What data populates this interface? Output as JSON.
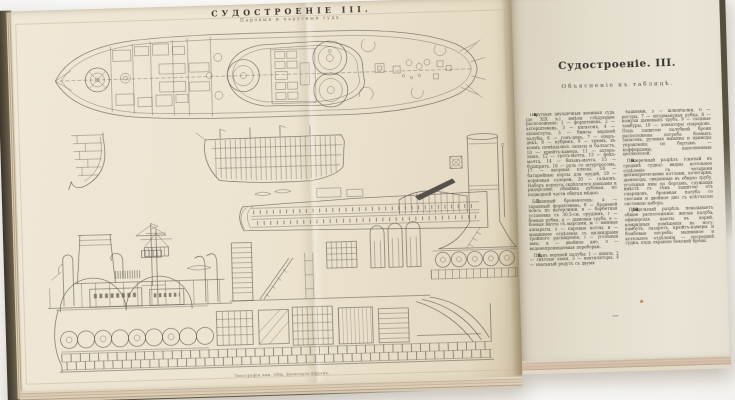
{
  "photo": {
    "background": "#fcfcfb"
  },
  "book": {
    "plate_page": {
      "title": "СУДОСТРОЕНІЕ III.",
      "subtitle": "Паровыя и парусныя суда.",
      "imprint": "Типографія Акц. Общ. Брокгаузъ-Ефронъ.",
      "figures": [
        "battleship-deck-plan-top-view",
        "bow-body-section",
        "sailing-warship-longitudinal-section",
        "military-mast-detail",
        "steamer-longitudinal-section-with-barbette-gun-and-funnel",
        "superstructure-side-view-with-funnels-and-mast",
        "hull-section-with-boilers-and-double-bottom"
      ]
    },
    "text_page": {
      "heading": "Судостроеніе. III.",
      "subheading": "Объясненіе къ таблицѣ.",
      "columns": [
        {
          "paragraphs": [
            {
              "lead": "6.",
              "text": "Парусныя двухдечныя военныя суда (до XIX в.) имѣли слѣдующее расположеніе: 1 — форштевень, 2 — ахтерштевень, 3 — кильсонъ, 4 — шпангоуты, 5 — бимсы верхней палубы, 6 — гонъ-декъ, 7 — оперъ-декъ, 8 — кубрикъ, 9 — трюмъ, въ коемъ помѣщались запасы и балластъ, 10 — крюйтъ-камера, 11 — ахтеръ-люкъ, 12 — гротъ-мачта, 13 — фокъ-мачта, 14 — бизань-мачта, 15 — бушпритъ, 16 — руль со штуртросомъ, 17 — якорные клюзы, 18 — батарейные порты для орудій, 19 — кормовыя галереи, 20 — гальюнъ. Наборъ корпуса скрѣплялся кницами и ридерсами; обшивка дубовая, по подводной части обитая мѣдью."
            },
            {
              "lead": "7.",
              "text": "Башенный броненосецъ: а — таранный форштевень, б — броневой поясъ по ватерлиніи, в — барбетная установка съ 30,5-см. орудіемъ, г — боевая рубка, д — дымовая труба, е — боевая мачта съ марсами, ж — минные аппараты, з — паровые котлы, и — машинное отдѣленіе съ цилиндрами тройного расширенія, і — угольныя ямы, к — двойное дно, л — водонепроницаемыя переборки."
            },
            {
              "lead": "8.",
              "text": "Планъ верхней палубы: 1 — шпиль, 2 — свѣтлые люки, 3 — вентиляторы, 4 — овальный редутъ съ двумя"
            }
          ]
        },
        {
          "paragraphs": [
            {
              "lead": "",
              "text": "башнями, 5 — шлюпбалки, 6 — ростры, 7 — штурманская рубка, 8 — кожухи дымовыхъ трубъ, 9 — сходные тамбуры, 10 — элеваторы снарядовъ. Подъ защитою палубной брони расположены погреба боевыхъ запасовъ, рулевая машина и приводы управленія; по бортамъ — коффердамы, наполненные целлюлозой."
            },
            {
              "lead": "9.",
              "text": "Поперечный разрѣзъ (снятый въ срединѣ судна): видны котельное отдѣленіе съ четырьмя цилиндрическими котлами, кочегарки, дымоходы, сведенные въ общую трубу, угольныя ямы по бортамъ, служащія вмѣстѣ съ тѣмъ защитою отъ снарядовъ, броневая палуба со скосами и двойное дно съ клѣтчатою системою набора."
            },
            {
              "lead": "10.",
              "text": "Продольный разрѣзъ показываетъ общее расположеніе: жилая палуба, офицерскія каюты въ кормѣ, командныя помѣщенія въ носу, камбузъ, лазаретъ, крюйтъ-камеры и бомбовые погреба; машинное и котельное отдѣленія — посрединѣ судна, подъ охраною боковой брони."
            }
          ]
        }
      ],
      "end_mark": "—"
    }
  }
}
